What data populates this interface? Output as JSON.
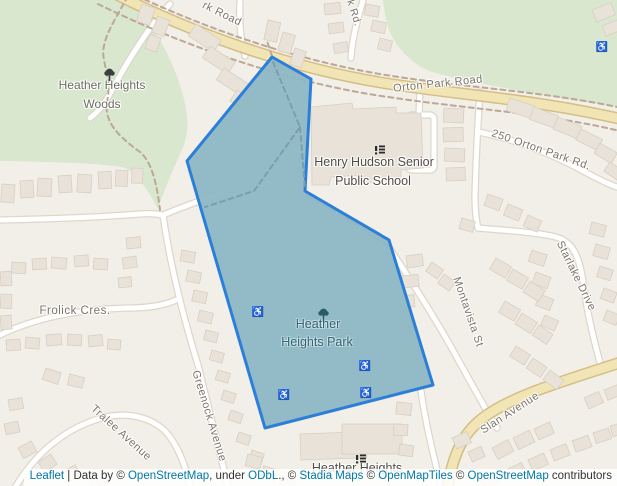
{
  "colors": {
    "c_land": "#f2efe8",
    "c_green": "#d9e7cf",
    "c_building": "#e9e2d8",
    "c_building_stroke": "#d7cfc2",
    "c_road_casing": "#ddd7cb",
    "c_yellow_casing": "#d4be85",
    "c_yellow_fill": "#f1e5b6",
    "c_trail": "#bca895",
    "c_park_trail": "#7b9dad",
    "c_park_fill": "#8cb8c5",
    "c_park_stroke": "#2b7fd8",
    "c_street_label": "#7b756a",
    "c_area_label": "#6d6d63",
    "c_poi_label": "#514e47",
    "c_park_label": "#2e6575",
    "c_wc_icon": "#3d5c6e",
    "c_link": "#0078A8",
    "c_attr_text": "#333333"
  },
  "map": {
    "labels": {
      "woods_line1": "Heather Heights",
      "woods_line2": "Woods",
      "orton_top_fragment": "rk Road",
      "k_rd_fragment": "k Rd.",
      "orton_main": "Orton Park Road",
      "addr_250": "250 Orton Park Rd.",
      "school_line1": "Henry Hudson Senior",
      "school_line2": "Public School",
      "frolick": "Frolick Cres.",
      "greenock": "Greenock Avenue",
      "tralee": "Tralee Avenue",
      "park_line1": "Heather",
      "park_line2": "Heights Park",
      "montavista": "Montavista St",
      "starlake": "Starlake Drive",
      "slan": "Slan Avenue",
      "heather_heights_south": "Heather Heights"
    },
    "icons": {
      "wheelchair": "♿",
      "tree": "tree-icon",
      "school": "school-icon"
    }
  },
  "attribution": {
    "s0": "Leaflet",
    "s1": " | Data by © ",
    "s2": "OpenStreetMap",
    "s3": ", under ",
    "s4": "ODbL",
    "s5": "., © ",
    "s6": "Stadia Maps",
    "s7": " © ",
    "s8": "OpenMapTiles",
    "s9": " © ",
    "s10": "OpenStreetMap",
    "s11": " contributors"
  }
}
